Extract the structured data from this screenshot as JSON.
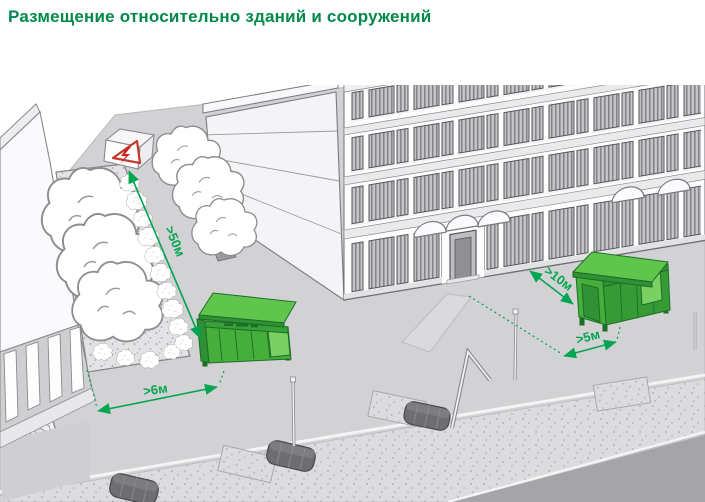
{
  "header": {
    "title": "Размещение относительно зданий и сооружений"
  },
  "scene": {
    "description": "Isometric street illustration: allowed distances for placing green waste-container shelters relative to buildings and structures",
    "dimension_labels": {
      "to_power_installation": ">50м",
      "to_green_zone": ">6м",
      "to_building_wall": ">10м",
      "to_entrance": ">5м"
    },
    "icons": {
      "warning_sign": "high-voltage-warning-icon"
    },
    "colors": {
      "title_green": "#00894a",
      "dimension_green": "#00a551",
      "container_green": "#46ae3a",
      "container_green_light": "#60c54c",
      "container_green_dark": "#2f9134",
      "warning_red": "#c2392b",
      "ground_gray": "#d2d2d4",
      "road_gray": "#a5a5a8"
    }
  }
}
